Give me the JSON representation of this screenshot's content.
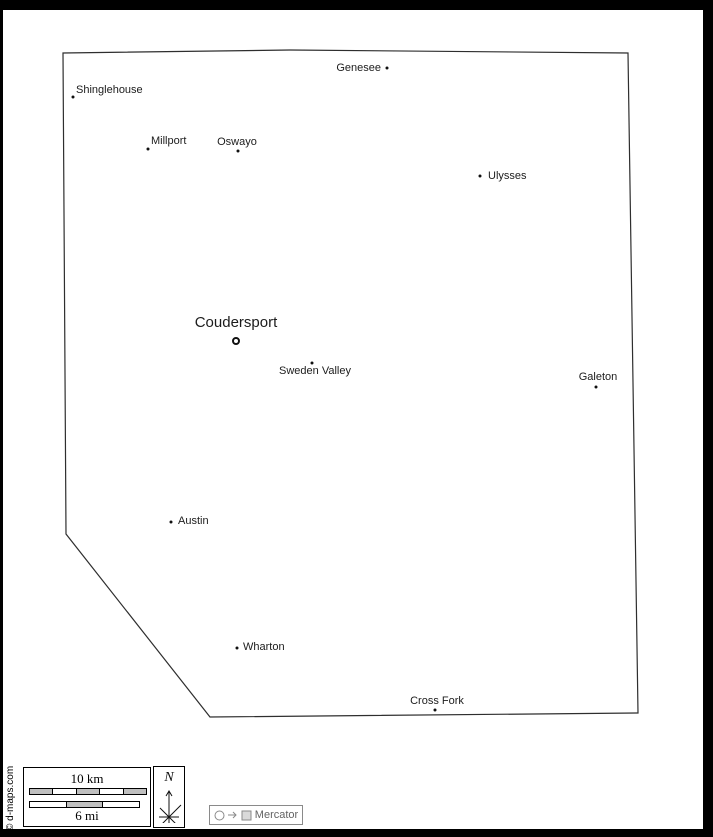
{
  "credit": "© d-maps.com",
  "compass": {
    "letter": "N"
  },
  "projection": {
    "label": "Mercator"
  },
  "scale": {
    "km_label": "10 km",
    "mi_label": "6 mi",
    "km_segments": [
      "gray",
      "white",
      "gray",
      "white",
      "gray"
    ],
    "mi_segments": [
      "white",
      "gray",
      "white"
    ]
  },
  "colors": {
    "segment_gray": "#bfbfbf",
    "segment_white": "#ffffff",
    "boundary": "#2e2e2e",
    "frame": "#000000",
    "legend_gray": "#8a8a8a"
  },
  "map": {
    "boundary_points": "63,53 290,50 628,53 638,713 210,717 66,534",
    "towns": [
      {
        "name": "Genesee",
        "dot_x": 387,
        "dot_y": 68,
        "label_x": 381,
        "label_y": 68,
        "anchor": "right",
        "seat": false
      },
      {
        "name": "Shinglehouse",
        "dot_x": 73,
        "dot_y": 97,
        "label_x": 76,
        "label_y": 90,
        "anchor": "left",
        "seat": false
      },
      {
        "name": "Millport",
        "dot_x": 148,
        "dot_y": 149,
        "label_x": 151,
        "label_y": 141,
        "anchor": "left",
        "seat": false
      },
      {
        "name": "Oswayo",
        "dot_x": 238,
        "dot_y": 151,
        "label_x": 237,
        "label_y": 142,
        "anchor": "center",
        "seat": false
      },
      {
        "name": "Ulysses",
        "dot_x": 480,
        "dot_y": 176,
        "label_x": 488,
        "label_y": 176,
        "anchor": "left",
        "seat": false
      },
      {
        "name": "Coudersport",
        "dot_x": 236,
        "dot_y": 341,
        "label_x": 236,
        "label_y": 323,
        "anchor": "center",
        "seat": true,
        "big": true
      },
      {
        "name": "Sweden Valley",
        "dot_x": 312,
        "dot_y": 363,
        "label_x": 315,
        "label_y": 371,
        "anchor": "center",
        "seat": false
      },
      {
        "name": "Galeton",
        "dot_x": 596,
        "dot_y": 387,
        "label_x": 598,
        "label_y": 377,
        "anchor": "center",
        "seat": false
      },
      {
        "name": "Austin",
        "dot_x": 171,
        "dot_y": 522,
        "label_x": 178,
        "label_y": 521,
        "anchor": "left",
        "seat": false
      },
      {
        "name": "Wharton",
        "dot_x": 237,
        "dot_y": 648,
        "label_x": 243,
        "label_y": 647,
        "anchor": "left",
        "seat": false
      },
      {
        "name": "Cross Fork",
        "dot_x": 435,
        "dot_y": 710,
        "label_x": 437,
        "label_y": 701,
        "anchor": "center",
        "seat": false
      }
    ]
  }
}
